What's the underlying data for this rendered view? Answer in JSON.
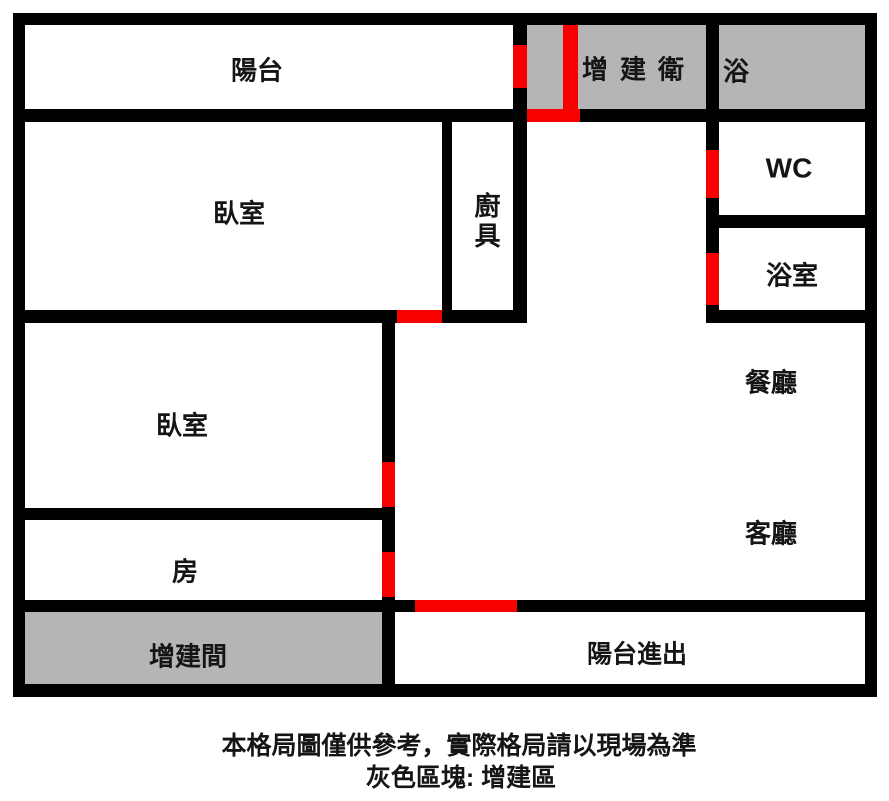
{
  "colors": {
    "wall": "#000000",
    "door": "#f70000",
    "annex": "#b5b5b5",
    "bg": "#ffffff",
    "ink": "#151515"
  },
  "rooms": {
    "balcony": "陽台",
    "annex_bath": "增建衛",
    "bath": "浴",
    "bedroom_top": "臥室",
    "kitchen": "廚具",
    "wc": "WC",
    "bathroom": "浴室",
    "dining": "餐廳",
    "bedroom_mid": "臥室",
    "living": "客廳",
    "room": "房",
    "annex_room": "增建間",
    "balcony_access": "陽台進出"
  },
  "caption": {
    "line1": "本格局圖僅供參考，實際格局請以現場為準",
    "line2": "灰色區塊: 增建區"
  }
}
